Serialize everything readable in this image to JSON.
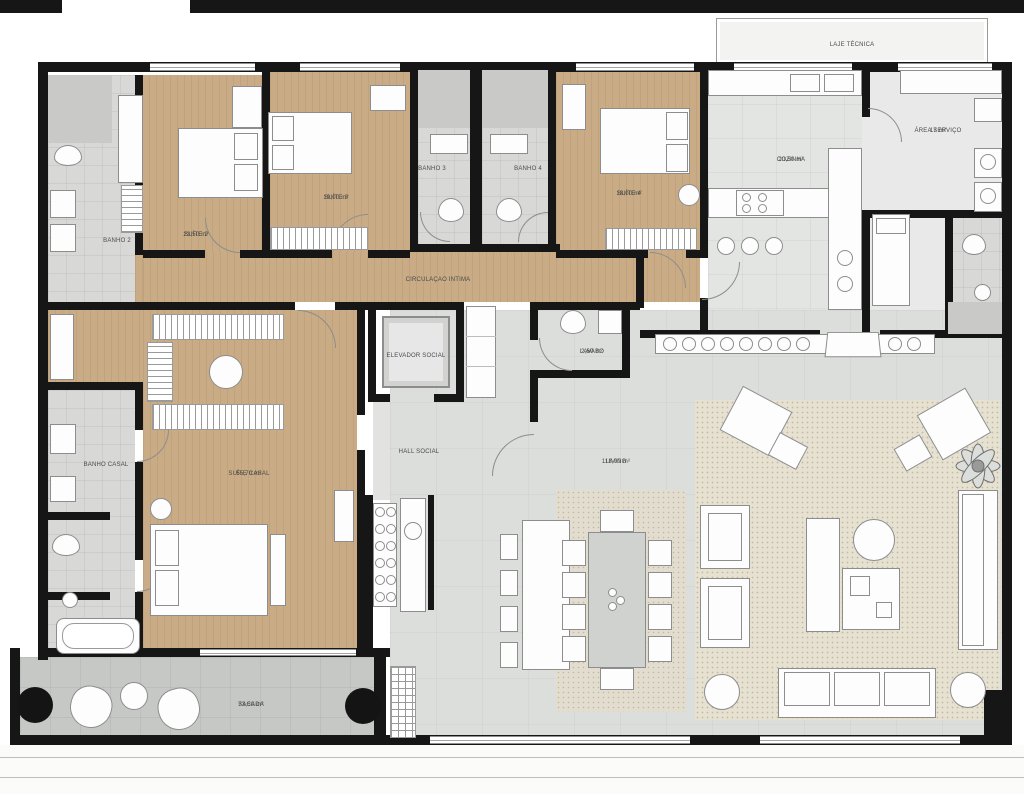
{
  "plan": {
    "colors": {
      "wall": "#161616",
      "wood": "#c9ac85",
      "bath": "#d8d9d7",
      "bath_dark": "#c9cac8",
      "kitchen": "#e3e5e3",
      "servico": "#e8e9e8",
      "living": "#dcdedb",
      "rug": "#e7e1d1",
      "rug_dot": "#c2b9a2",
      "dining_rug": "#e3ddcf",
      "balcony": "#c6c8c5",
      "hall": "#e2e3e1",
      "laje": "#f3f4f2",
      "furn_line": "#8d8d8d",
      "label_text": "#4a4a4a"
    },
    "rooms": {
      "laje_tecnica": {
        "label": "LAJE TÉCNICA"
      },
      "banho_2": {
        "label": "BANHO 2"
      },
      "suite_2": {
        "label": "SUÍTE 2",
        "area": "23,50 m²"
      },
      "suite_3": {
        "label": "SUÍTE 3",
        "area": "19,00 m²"
      },
      "banho_3": {
        "label": "BANHO 3"
      },
      "banho_4": {
        "label": "BANHO 4"
      },
      "suite_4": {
        "label": "SUÍTE 4",
        "area": "18,00 m²"
      },
      "cozinha": {
        "label": "COZINHA",
        "area": "20,50 m²"
      },
      "area_servico": {
        "label": "ÁREA SERVIÇO",
        "area": "17 m²"
      },
      "circulacao_intima": {
        "label": "CIRCULAÇÃO ÍNTIMA"
      },
      "elevador_social": {
        "label": "ELEVADOR SOCIAL"
      },
      "lavabo": {
        "label": "LAVABO",
        "area": "2,60 m²"
      },
      "hall_social": {
        "label": "HALL SOCIAL"
      },
      "banho_casal": {
        "label": "BANHO CASAL"
      },
      "suite_casal": {
        "label": "SUÍTE CASAL",
        "area": "55,70 m²"
      },
      "living": {
        "label": "LIVING",
        "area": "118,00 m²"
      },
      "sacada": {
        "label": "SACADA",
        "area": "73,50 m²"
      }
    }
  }
}
